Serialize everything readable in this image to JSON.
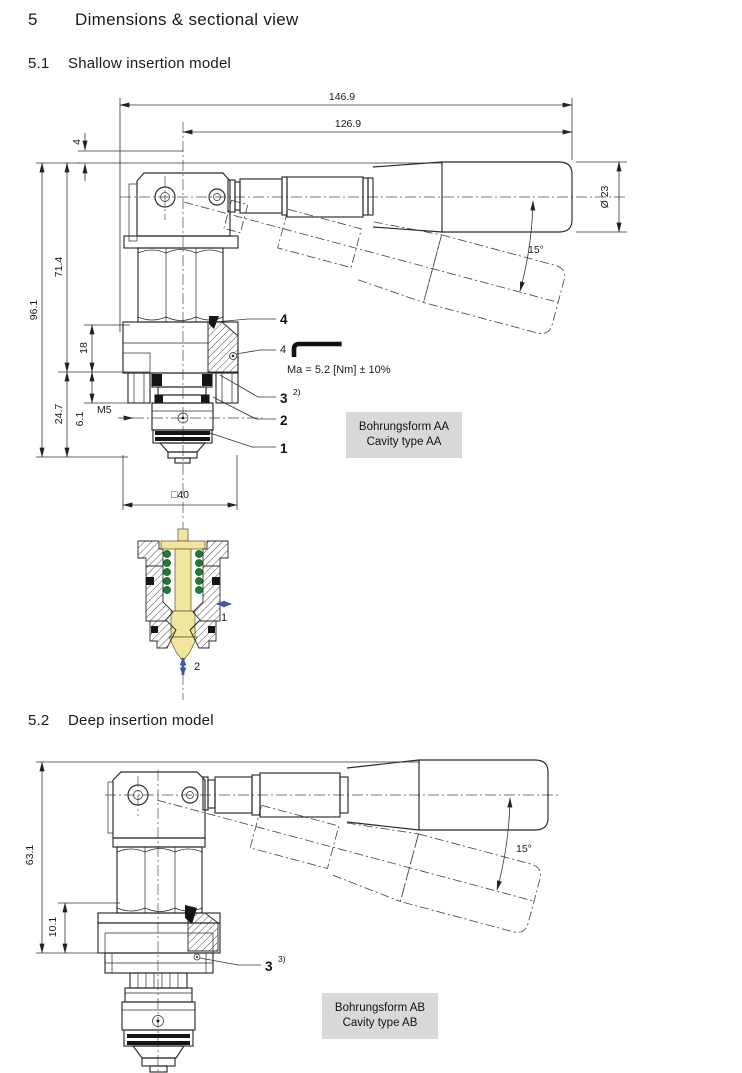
{
  "sections": {
    "s5": {
      "num": "5",
      "title": "Dimensions & sectional view"
    },
    "s51": {
      "num": "5.1",
      "title": "Shallow insertion model"
    },
    "s52": {
      "num": "5.2",
      "title": "Deep insertion model"
    }
  },
  "shallow": {
    "dim_overall": "146.9",
    "dim_lever": "126.9",
    "dim_offset": "4",
    "dim_diameter": "Ø 23",
    "dim_angle": "15°",
    "dim_total_height": "96.1",
    "dim_upper_height": "71.4",
    "dim_body_height": "18",
    "dim_insert_depth": "24.7",
    "dim_thread_depth": "6.1",
    "thread_label": "M5",
    "dim_flange": "□40",
    "callout_seal": "4",
    "callout_screw": "4",
    "torque_note": "Ma = 5.2 [Nm] ± 10%",
    "callout_3": "3",
    "callout_3_sup": "2)",
    "callout_2": "2",
    "callout_1": "1",
    "cavity_line1": "Bohrungsform AA",
    "cavity_line2": "Cavity type AA"
  },
  "section_view": {
    "port1": "1",
    "port2": "2"
  },
  "deep": {
    "dim_total_height": "63.1",
    "dim_flange_height": "10.1",
    "dim_angle": "15°",
    "callout_3": "3",
    "callout_3_sup": "3)",
    "cavity_line1": "Bohrungsform AB",
    "cavity_line2": "Cavity type AB"
  },
  "colors": {
    "spool_yellow": "#f2e69e",
    "spring_green": "#1e7b33",
    "flow_arrow_blue": "#3c56a8",
    "cavity_box_gray": "#d9d9d9",
    "line": "#2b2b2b"
  }
}
